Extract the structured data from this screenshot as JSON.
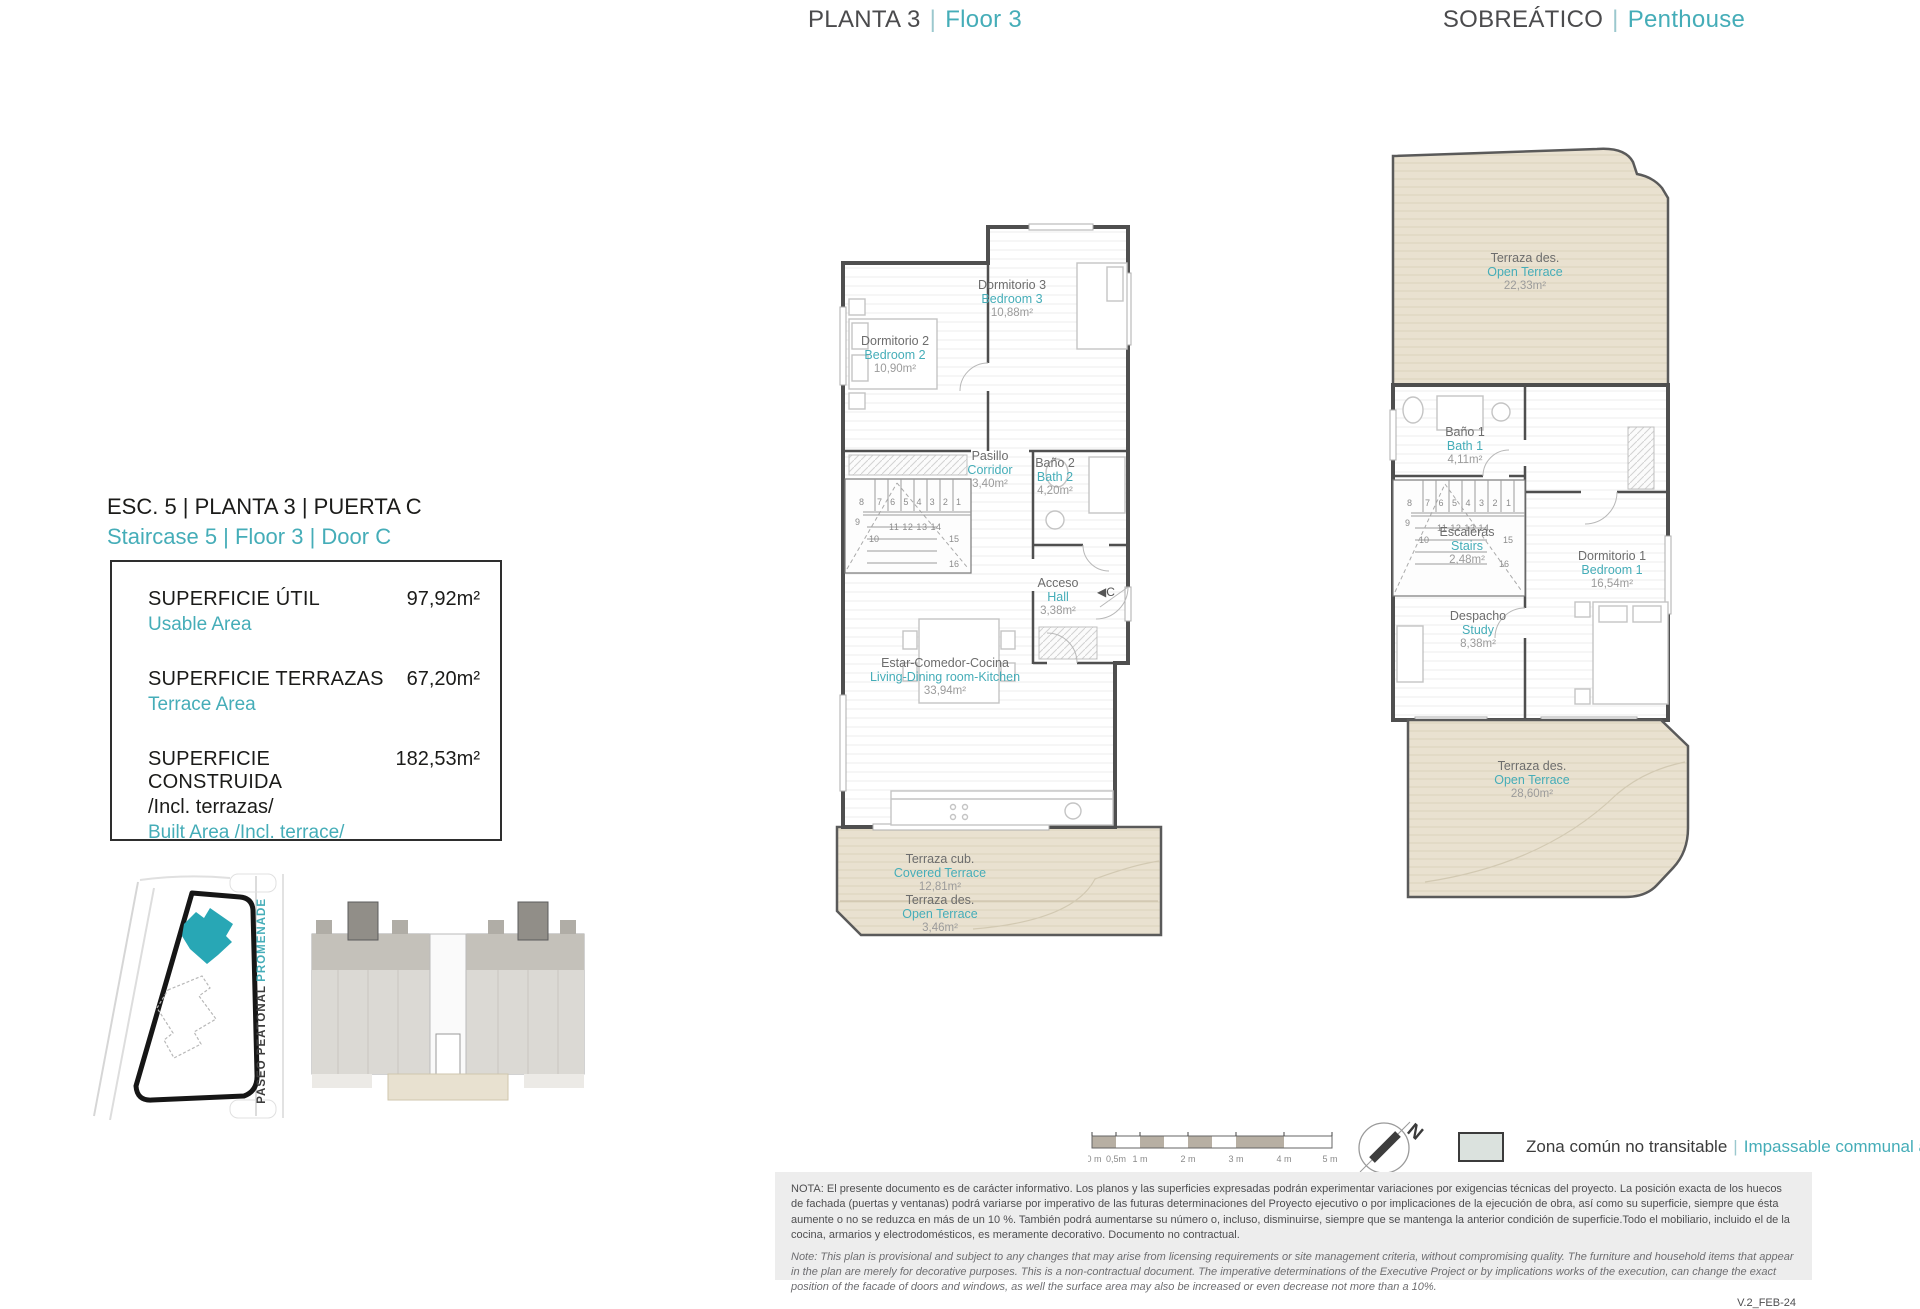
{
  "colors": {
    "accent": "#45ADB8",
    "site_building_teal": "#28A7B5",
    "terrace_deck": "#E9E1D0",
    "legend_swatch": "#DBE2DE",
    "note_band_bg": "#EDEDED"
  },
  "divider": "|",
  "headers": {
    "floor_es": "PLANTA 3",
    "floor_en": "Floor 3",
    "pent_es": "SOBREÁTICO",
    "pent_en": "Penthouse"
  },
  "unit": {
    "title_es": "ESC. 5 | PLANTA 3 | PUERTA C",
    "title_en": "Staircase 5 | Floor 3 | Door C"
  },
  "areas": {
    "usable_label": "SUPERFICIE ÚTIL",
    "usable_sub": "Usable Area",
    "usable_value": "97,92m²",
    "terrace_label": "SUPERFICIE TERRAZAS",
    "terrace_sub": "Terrace Area",
    "terrace_value": "67,20m²",
    "built_label": "SUPERFICIE CONSTRUIDA",
    "built_label2": "/Incl. terrazas/",
    "built_sub": "Built Area /Incl. terrace/",
    "built_value": "182,53m²"
  },
  "site": {
    "promenade": "PROMENADE",
    "street": "PASEO PEATONAL"
  },
  "plan_floor3": {
    "rooms": [
      {
        "es": "Dormitorio 2",
        "en": "Bedroom 2",
        "area": "10,90m²"
      },
      {
        "es": "Dormitorio 3",
        "en": "Bedroom 3",
        "area": "10,88m²"
      },
      {
        "es": "Pasillo",
        "en": "Corridor",
        "area": "3,40m²"
      },
      {
        "es": "Baño 2",
        "en": "Bath 2",
        "area": "4,20m²"
      },
      {
        "es": "Acceso",
        "en": "Hall",
        "area": "3,38m²"
      },
      {
        "es": "Estar-Comedor-Cocina",
        "en": "Living-Dining room-Kitchen",
        "area": "33,94m²"
      },
      {
        "es": "Terraza cub.",
        "en": "Covered Terrace",
        "area": "12,81m²"
      },
      {
        "es": "Terraza des.",
        "en": "Open Terrace",
        "area": "3,46m²"
      }
    ],
    "stairs": [
      "8",
      "7 6 5 4 3 2 1",
      "9",
      "10",
      "11 12 13 14",
      "15",
      "16"
    ],
    "entry_marker": "◀C"
  },
  "plan_penthouse": {
    "rooms": [
      {
        "es": "Terraza des.",
        "en": "Open Terrace",
        "area": "22,33m²"
      },
      {
        "es": "Baño 1",
        "en": "Bath 1",
        "area": "4,11m²"
      },
      {
        "es": "Escaleras",
        "en": "Stairs",
        "area": "2,48m²"
      },
      {
        "es": "Dormitorio 1",
        "en": "Bedroom 1",
        "area": "16,54m²"
      },
      {
        "es": "Despacho",
        "en": "Study",
        "area": "8,38m²"
      },
      {
        "es": "Terraza des.",
        "en": "Open Terrace",
        "area": "28,60m²"
      }
    ],
    "stairs": [
      "8",
      "7 6 5 4 3 2 1",
      "9",
      "10",
      "11 12 13 14",
      "15",
      "16"
    ]
  },
  "scalebar": {
    "labels": [
      "0 m",
      "0,5m",
      "1 m",
      "2 m",
      "3 m",
      "4 m",
      "5 m"
    ]
  },
  "compass": {
    "north": "N"
  },
  "legend": {
    "es": "Zona común no transitable",
    "en": "Impassable communal area"
  },
  "notes": {
    "es": "NOTA:  El presente documento es de carácter informativo. Los planos y las superficies expresadas podrán experimentar variaciones por exigencias técnicas del proyecto. La posición exacta de los huecos de fachada (puertas y ventanas) podrá variarse por imperativo de las futuras determinaciones del Proyecto ejecutivo o por implicaciones de la ejecución de obra, así como su superficie, siempre que ésta aumente o no se reduzca en más de un 10 %. También podrá aumentarse su número o, incluso, disminuirse, siempre que se mantenga la anterior condición de superficie.Todo el mobiliario, incluido el de la cocina, armarios y electrodomésticos, es meramente decorativo. Documento no contractual.",
    "en": "Note: This plan is provisional and subject to any changes that may arise from licensing requirements or site management criteria, without compromising quality. The furniture and household items that appear in the plan are merely for decorative purposes. This is a non-contractual document. The imperative determinations of the Executive Project or by implications works of the execution, can change the exact position of the facade of doors and windows, as well the surface area may also be increased or even decrease not more than a 10%.",
    "version": "V.2_FEB-24"
  }
}
